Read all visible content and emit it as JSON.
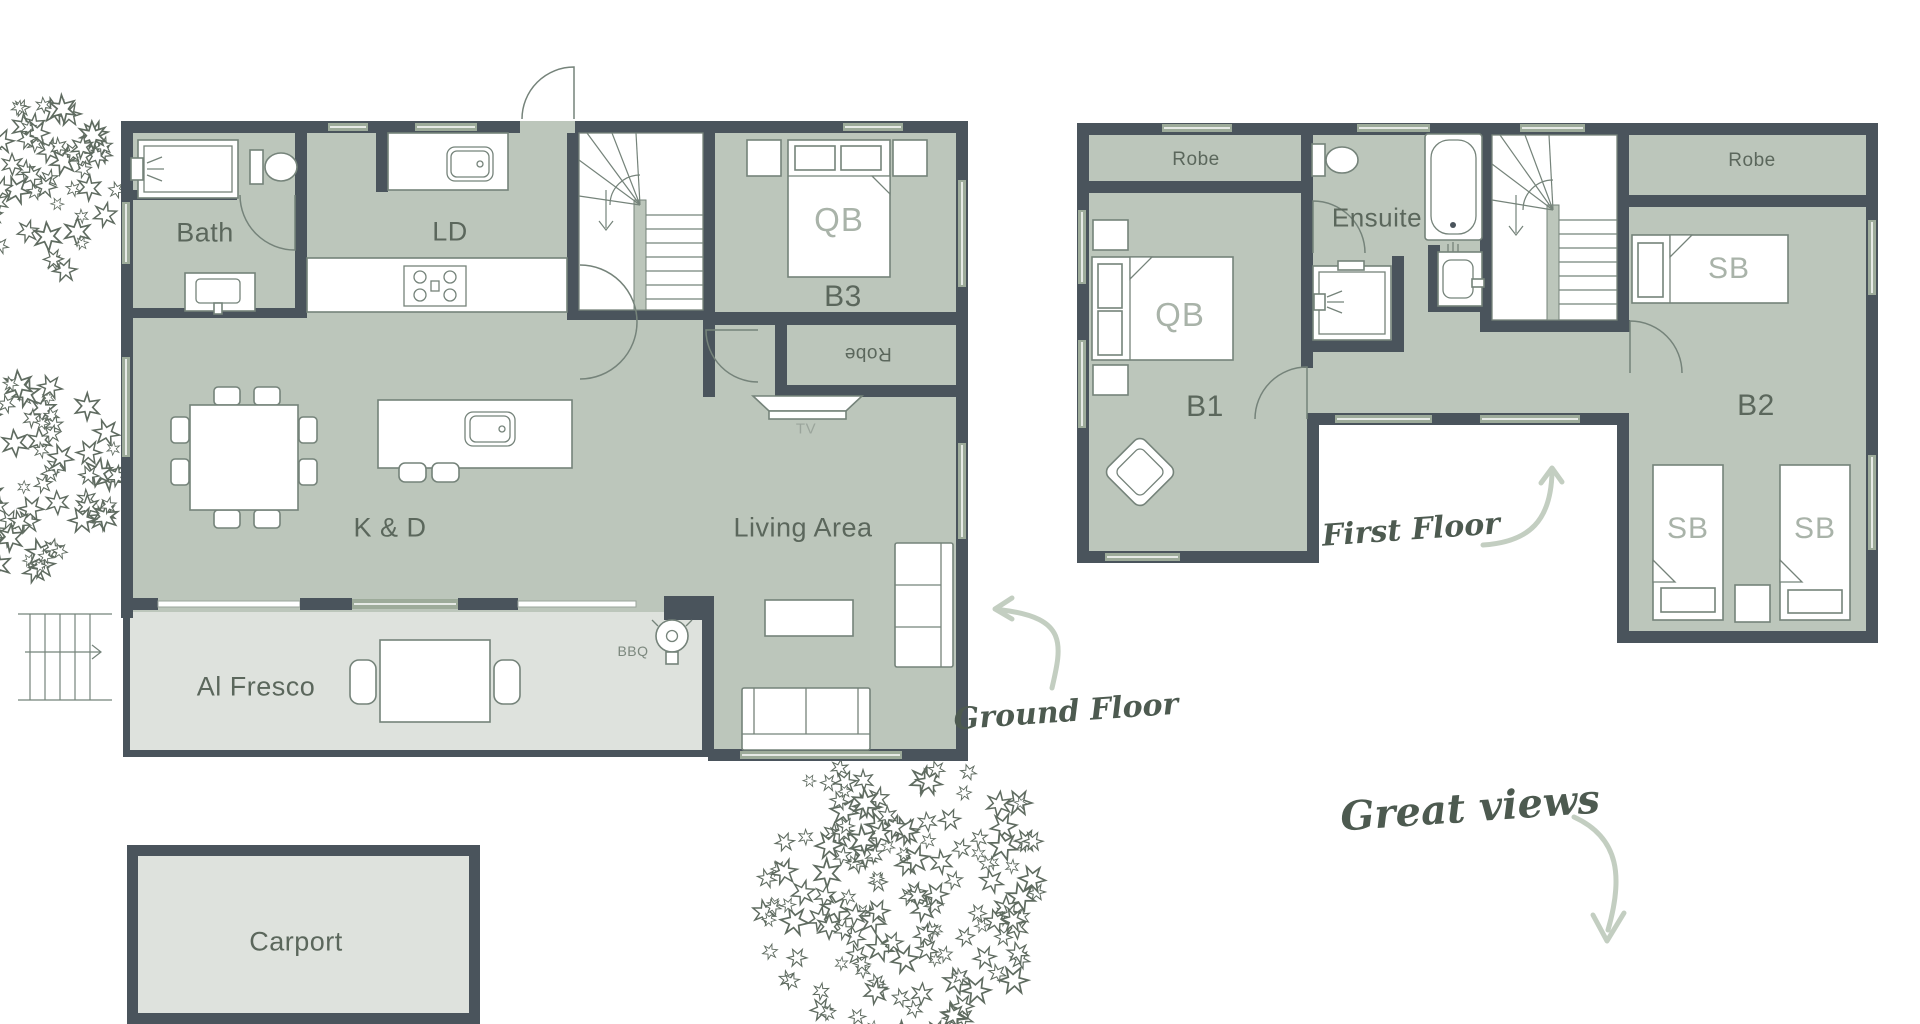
{
  "ground_floor": {
    "rooms": {
      "bath": "Bath",
      "laundry": "LD",
      "bedroom3": "B3",
      "robe": "Robe",
      "kitchen_dining": "K & D",
      "living": "Living Area",
      "alfresco": "Al Fresco",
      "carport": "Carport"
    },
    "furniture": {
      "queen_bed": "QB",
      "tv": "TV",
      "bbq": "BBQ"
    }
  },
  "first_floor": {
    "rooms": {
      "robe_b1": "Robe",
      "ensuite": "Ensuite",
      "robe_b2": "Robe",
      "bedroom1": "B1",
      "bedroom2": "B2"
    },
    "furniture": {
      "queen_bed": "QB",
      "single_bed_top": "SB",
      "single_bed_left": "SB",
      "single_bed_right": "SB"
    }
  },
  "annotations": {
    "ground_floor": "Ground Floor",
    "first_floor": "First Floor",
    "great_views": "Great views"
  },
  "colors": {
    "room_fill": "#bcc6bb",
    "deck_fill": "#dee2dd",
    "wall": "#4a545c",
    "window": "#9dab9a",
    "label": "#5b675c",
    "furniture_label": "#a9b3a9",
    "handwriting": "#4d5a50",
    "arrow": "#c3cec1"
  }
}
